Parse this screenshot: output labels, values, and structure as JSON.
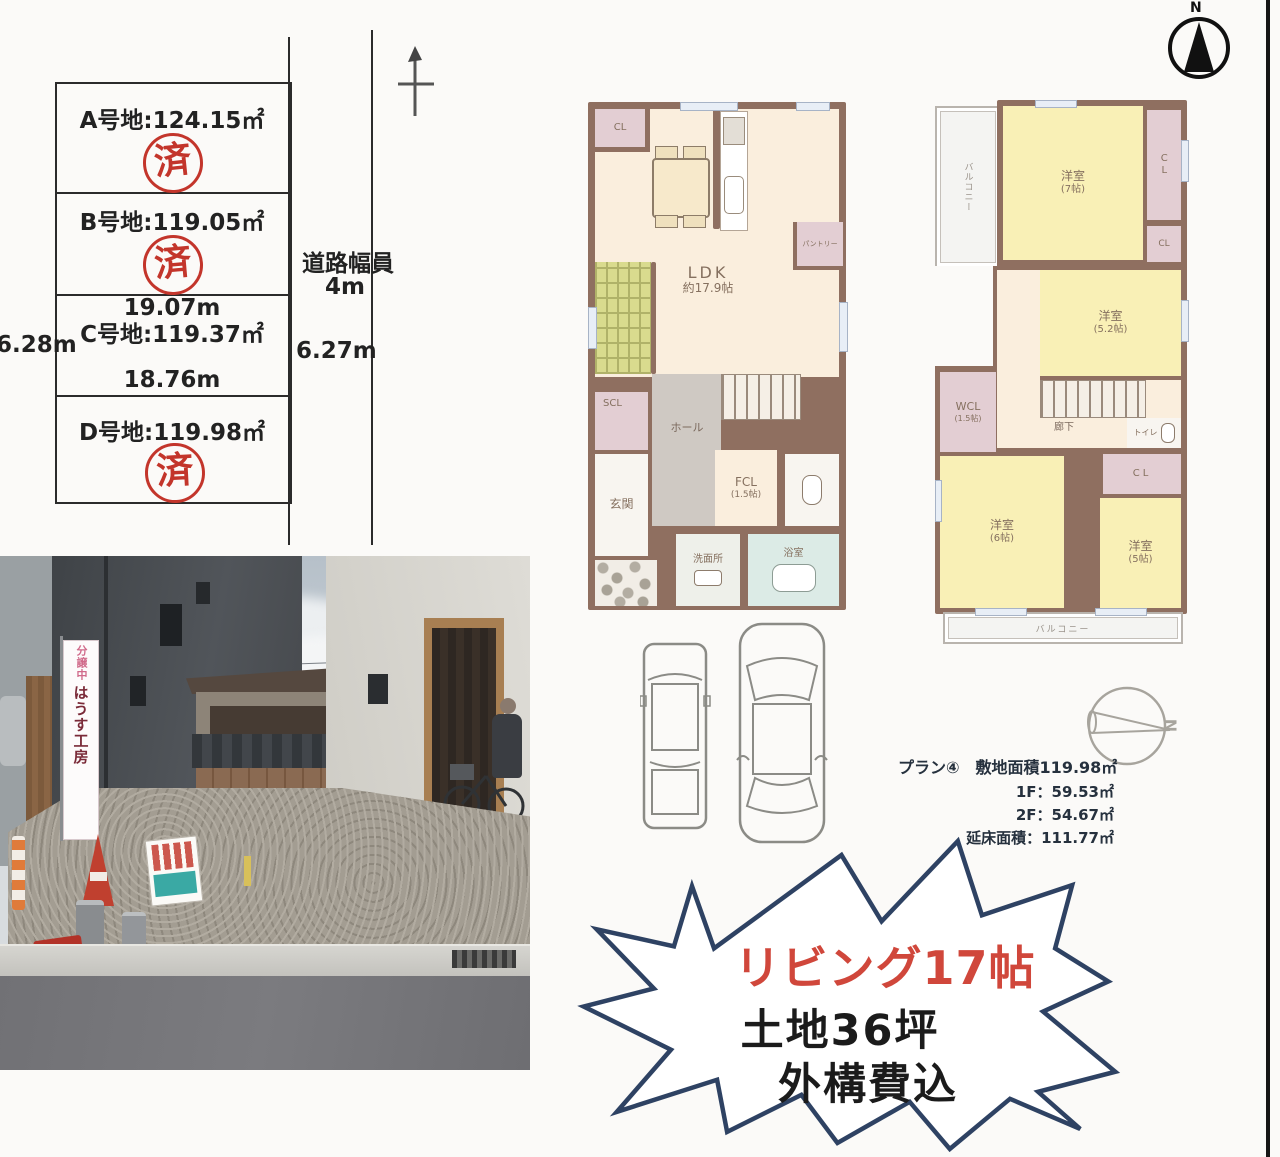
{
  "compass_top": {
    "label": "N"
  },
  "lot_diagram": {
    "road_width_label": "道路幅員",
    "road_width_value": "4m",
    "lot_a_label": "A号地:124.15㎡",
    "lot_b_label": "B号地:119.05㎡",
    "lot_c_label": "C号地:119.37㎡",
    "lot_d_label": "D号地:119.98㎡",
    "sold_stamp": "済",
    "dim_top": "19.07m",
    "dim_bottom": "18.76m",
    "dim_left": "6.28m",
    "dim_right": "6.27m"
  },
  "floor_plan_1f": {
    "cl": "CL",
    "ldk_line1": "LDK",
    "ldk_line2": "約17.9帖",
    "pantry": "パントリー",
    "scl": "SCL",
    "hall": "ホール",
    "genkan": "玄関",
    "fcl_line1": "FCL",
    "fcl_line2": "(1.5帖)",
    "washroom": "洗面所",
    "bathroom": "浴室"
  },
  "floor_plan_2f": {
    "balcony_left": "バルコニー",
    "room7_line1": "洋室",
    "room7_line2": "(7帖)",
    "cl1": "CL",
    "cl2": "CL",
    "cl3": "CL",
    "room52_line1": "洋室",
    "room52_line2": "(5.2帖)",
    "wcl_line1": "WCL",
    "wcl_line2": "(1.5帖)",
    "hallway": "廊下",
    "toilet": "トイレ",
    "room6_line1": "洋室",
    "room6_line2": "(6帖)",
    "room5_line1": "洋室",
    "room5_line2": "(5帖)",
    "balcony_bottom": "バルコニー"
  },
  "plan_info": {
    "line1": "プラン④　敷地面積119.98㎡",
    "line2": "1F：59.53㎡",
    "line3": "2F：54.67㎡",
    "line4": "延床面積：111.77㎡",
    "compass_label": "N"
  },
  "starburst": {
    "line1": "リビング17帖",
    "line2": "土地36坪",
    "line3": "外構費込"
  },
  "photo": {
    "banner_top": "分譲中",
    "banner_main": "はうす工房"
  }
}
